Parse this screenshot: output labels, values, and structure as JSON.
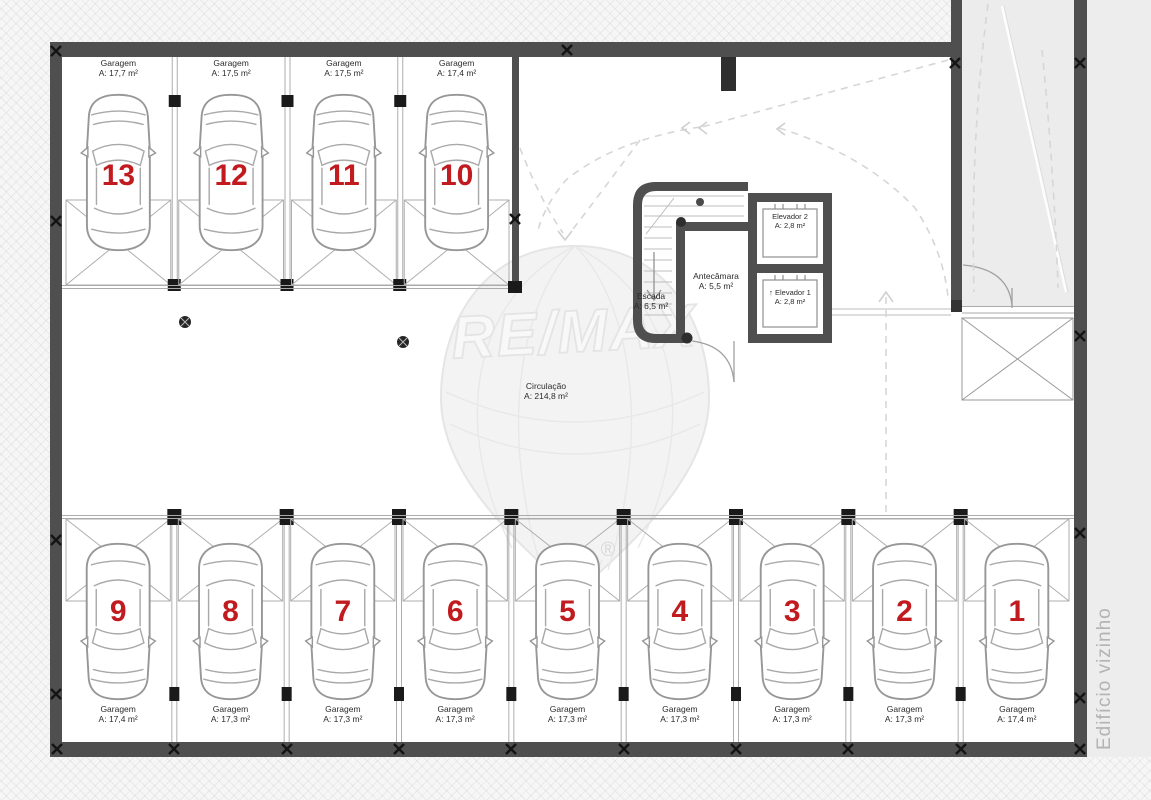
{
  "plan": {
    "top_stalls": [
      {
        "number": "13",
        "name": "Garagem",
        "area": "A: 17,7 m²"
      },
      {
        "number": "12",
        "name": "Garagem",
        "area": "A: 17,5 m²"
      },
      {
        "number": "11",
        "name": "Garagem",
        "area": "A: 17,5 m²"
      },
      {
        "number": "10",
        "name": "Garagem",
        "area": "A: 17,4 m²"
      }
    ],
    "bottom_stalls": [
      {
        "number": "9",
        "name": "Garagem",
        "area": "A: 17,4 m²"
      },
      {
        "number": "8",
        "name": "Garagem",
        "area": "A: 17,3 m²"
      },
      {
        "number": "7",
        "name": "Garagem",
        "area": "A: 17,3 m²"
      },
      {
        "number": "6",
        "name": "Garagem",
        "area": "A: 17,3 m²"
      },
      {
        "number": "5",
        "name": "Garagem",
        "area": "A: 17,3 m²"
      },
      {
        "number": "4",
        "name": "Garagem",
        "area": "A: 17,3 m²"
      },
      {
        "number": "3",
        "name": "Garagem",
        "area": "A: 17,3 m²"
      },
      {
        "number": "2",
        "name": "Garagem",
        "area": "A: 17,3 m²"
      },
      {
        "number": "1",
        "name": "Garagem",
        "area": "A: 17,4 m²"
      }
    ],
    "rooms": {
      "escada": {
        "name": "Escada",
        "area": "A: 6,5 m²"
      },
      "antecamara": {
        "name": "Antecâmara",
        "area": "A: 5,5 m²"
      },
      "elevador2": {
        "name": "Elevador 2",
        "area": "A: 2,8 m²"
      },
      "elevador1": {
        "name": "↑ Elevador 1",
        "area": "A: 2,8 m²"
      },
      "circulacao": {
        "name": "Circulação",
        "area": "A: 214,8 m²"
      }
    },
    "neighbor_label": "Edifício vizinho"
  },
  "watermark": {
    "text": "RE/MAX",
    "reg": "®"
  },
  "colors": {
    "wall": "#4f4f4f",
    "stall_number": "#c11b20",
    "thin_line": "#aaaaaa",
    "dashed_path": "#d6d6d6",
    "ramp_fill": "#ececec",
    "neighbor_strip": "#ededed",
    "neighbor_text": "#b3b3b3"
  }
}
